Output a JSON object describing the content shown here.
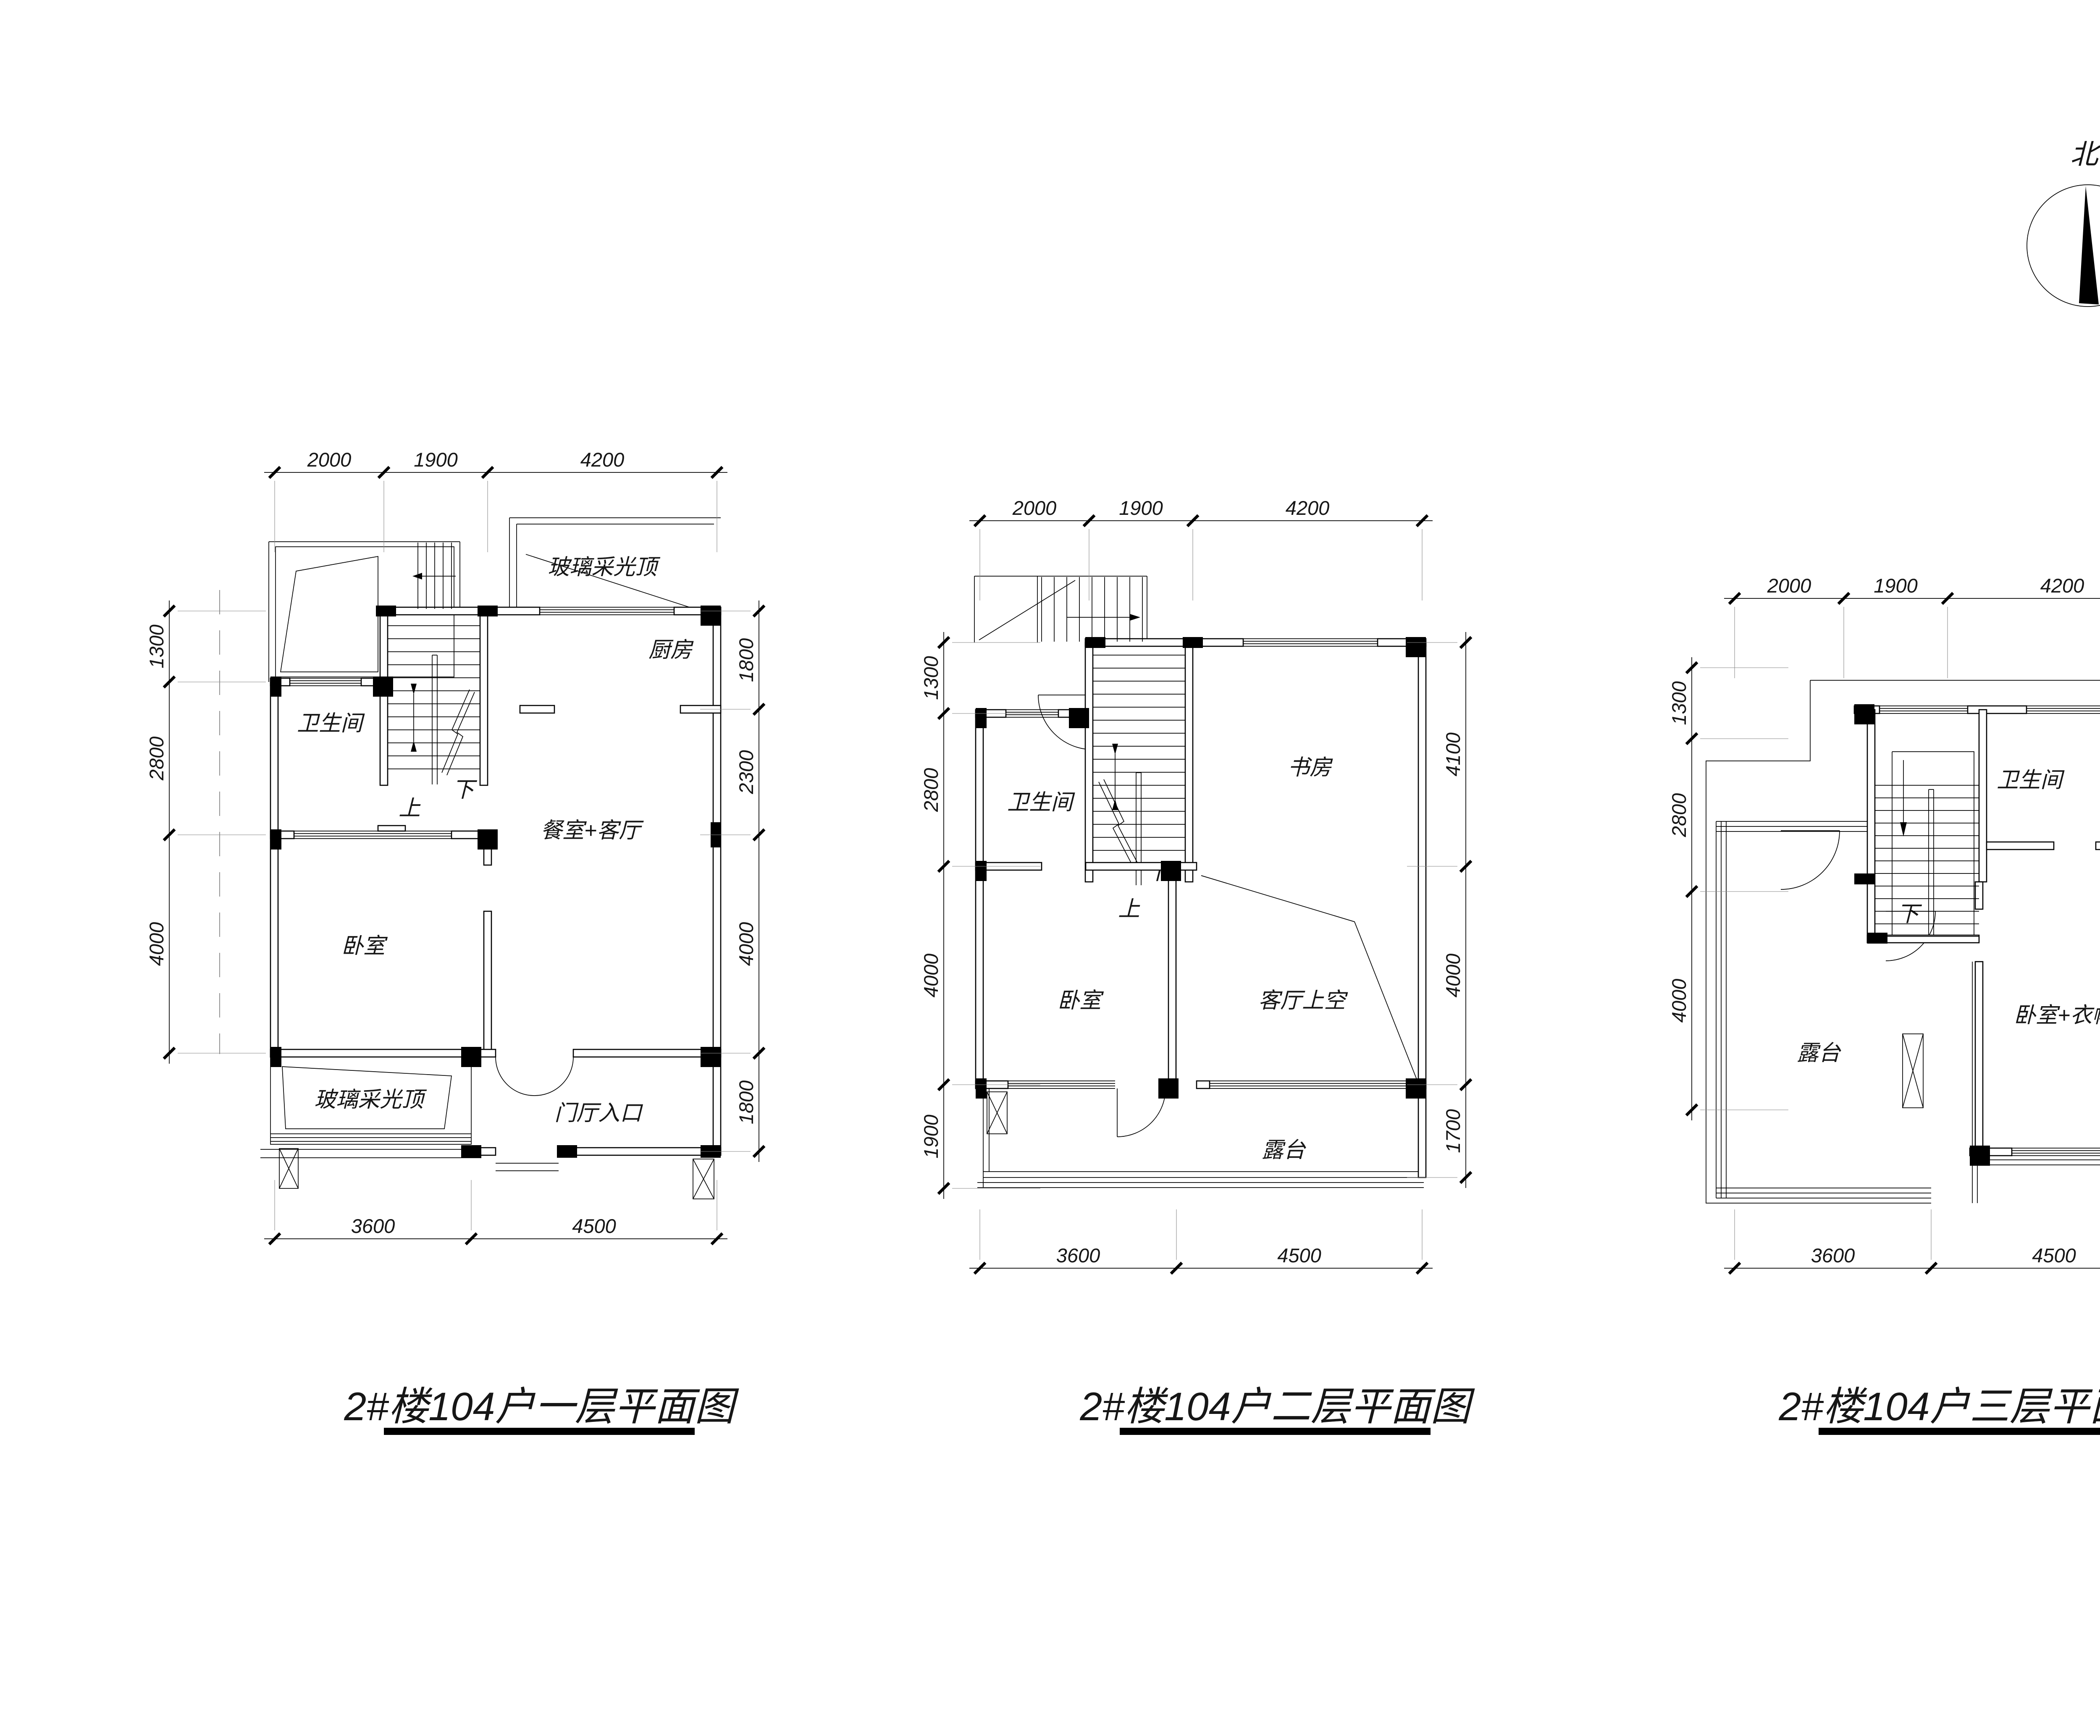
{
  "north_label": "北",
  "plans": [
    {
      "title": "2#楼104户一层平面图",
      "dims": {
        "top": [
          "2000",
          "1900",
          "4200"
        ],
        "left": [
          "1300",
          "2800",
          "4000"
        ],
        "right": [
          "1800",
          "2300",
          "4000",
          "1800"
        ],
        "bottom": [
          "3600",
          "4500"
        ]
      },
      "labels": {
        "bathroom": "卫生间",
        "kitchen": "厨房",
        "skylight_top": "玻璃采光顶",
        "dining_living": "餐室+客厅",
        "bedroom": "卧室",
        "skylight_bottom": "玻璃采光顶",
        "entry": "门厅入口",
        "up": "上",
        "down": "下"
      }
    },
    {
      "title": "2#楼104户二层平面图",
      "dims": {
        "top": [
          "2000",
          "1900",
          "4200"
        ],
        "left": [
          "1300",
          "2800",
          "4000",
          "1900"
        ],
        "right": [
          "4100",
          "4000",
          "1700"
        ],
        "bottom": [
          "3600",
          "4500"
        ]
      },
      "labels": {
        "bathroom": "卫生间",
        "study": "书房",
        "bedroom": "卧室",
        "living_void": "客厅上空",
        "terrace": "露台",
        "up": "上",
        "down": "下"
      }
    },
    {
      "title": "2#楼104户三层平面图",
      "dims": {
        "top": [
          "2000",
          "1900",
          "4200"
        ],
        "left": [
          "1300",
          "2800",
          "4000"
        ],
        "right": [
          "2000",
          "2100",
          "4000"
        ],
        "bottom": [
          "3600",
          "4500"
        ]
      },
      "labels": {
        "bathroom": "卫生间",
        "bedroom_cloak": "卧室+衣帽间",
        "terrace": "露台",
        "down": "下"
      }
    }
  ]
}
